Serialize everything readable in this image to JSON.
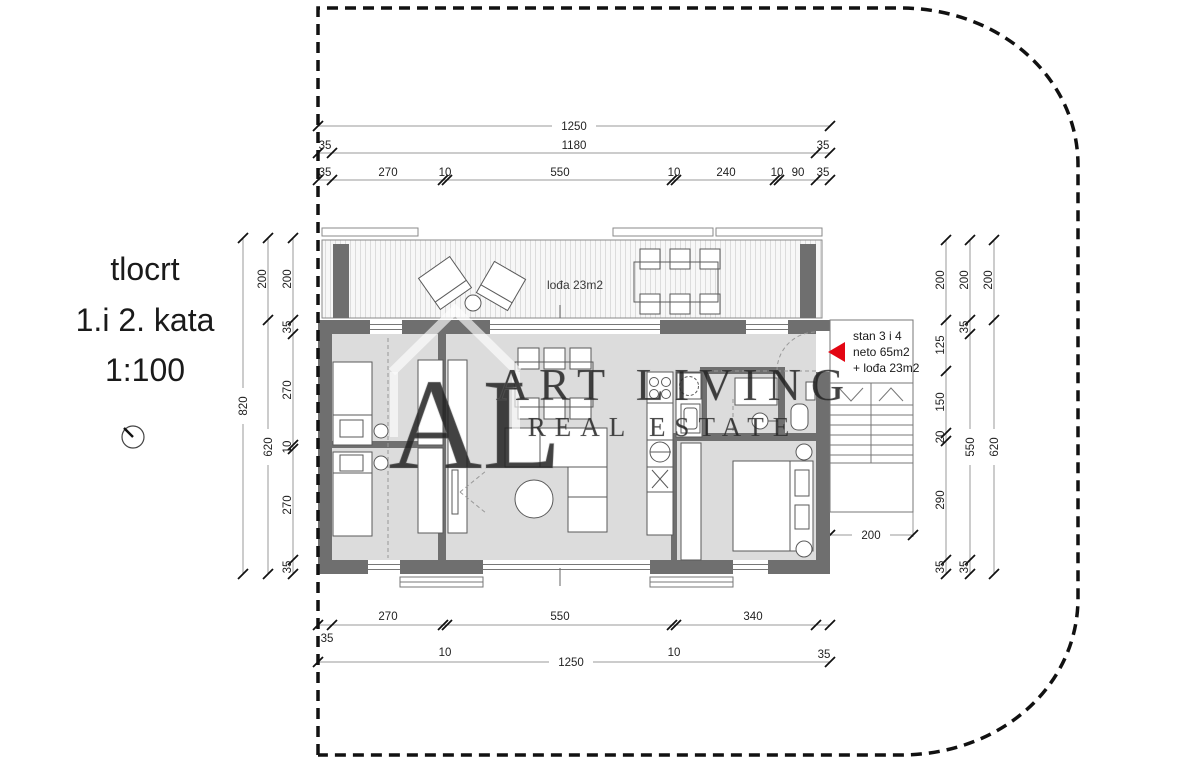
{
  "title": {
    "line1": "tlocrt",
    "line2": "1.i 2. kata",
    "line3": "1:100"
  },
  "labels": {
    "loggia": "lođa 23m2",
    "unit": {
      "line1": "stan 3 i 4",
      "line2": "neto 65m2",
      "line3": "+ lođa 23m2"
    }
  },
  "watermark": {
    "logo": "AL",
    "line1": "ART LIVING",
    "line2": "REAL ESTATE"
  },
  "dims": {
    "top_row1": [
      "1250"
    ],
    "top_row2": [
      "35",
      "1180",
      "35"
    ],
    "top_row3": [
      "35",
      "270",
      "10",
      "550",
      "10",
      "240",
      "10",
      "90",
      "35"
    ],
    "bottom_row1": [
      "35",
      "270",
      "10",
      "550",
      "10",
      "340",
      "35"
    ],
    "bottom_row2": [
      "1250"
    ],
    "left_outer": [
      "820"
    ],
    "left_mid": [
      "200",
      "620"
    ],
    "left_inner": [
      "200",
      "35",
      "270",
      "10",
      "270",
      "35"
    ],
    "right_inner": [
      "200",
      "125",
      "150",
      "20",
      "290",
      "35"
    ],
    "right_mid": [
      "200",
      "35",
      "550",
      "35"
    ],
    "right_outer": [
      "200",
      "620"
    ],
    "stairs": [
      "200"
    ]
  },
  "colors": {
    "wall": "#6f6f6f",
    "floor": "#dcdcdc",
    "accent_red": "#e30613",
    "dim_line": "#9a9a9a",
    "boundary": "#111111"
  }
}
